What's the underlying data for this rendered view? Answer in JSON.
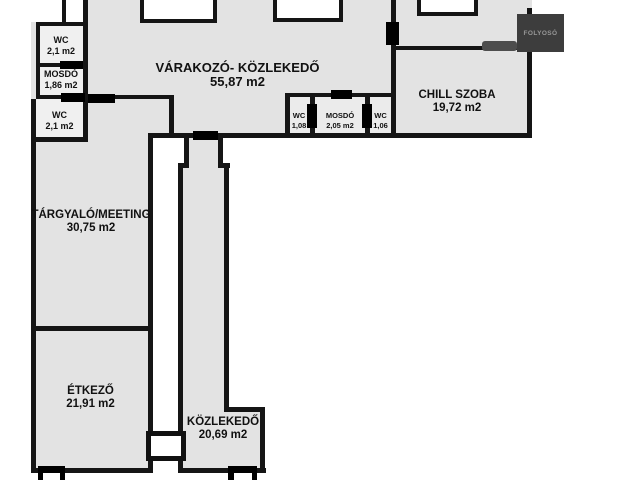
{
  "rooms": {
    "wc_top": {
      "name": "WC",
      "area": "2,1 m2"
    },
    "mosdo": {
      "name": "MOSDÓ",
      "area": "1,86 m2"
    },
    "wc_middle": {
      "name": "WC",
      "area": "2,1 m2"
    },
    "varakozo": {
      "name": "VÁRAKOZÓ- KÖZLEKEDŐ",
      "area": "55,87 m2"
    },
    "chill_szoba": {
      "name": "CHILL SZOBA",
      "area": "19,72 m2"
    },
    "wc_small_left": {
      "name": "WC",
      "area": "1,08"
    },
    "mosdo_small": {
      "name": "MOSDÓ",
      "area": "2,05 m2"
    },
    "wc_small_right": {
      "name": "WC",
      "area": "1,06"
    },
    "targyalo": {
      "name": "TÁRGYALÓ/MEETING",
      "area": "30,75 m2"
    },
    "etkezo": {
      "name": "ÉTKEZŐ",
      "area": "21,91 m2"
    },
    "kozlekedo": {
      "name": "KÖZLEKEDŐ",
      "area": "20,69 m2"
    },
    "folyoso": {
      "name": "FOLYOSÓ"
    }
  },
  "colors": {
    "background": "#ffffff",
    "floor": "#e3e3e3",
    "floor_light": "#f0f0f0",
    "wall": "#151515",
    "door_marker": "#000000",
    "door_marker_gray": "#4d4d4d",
    "folyoso_box": "#3d3d3d",
    "folyoso_text": "#979797",
    "label_text": "#111111"
  }
}
